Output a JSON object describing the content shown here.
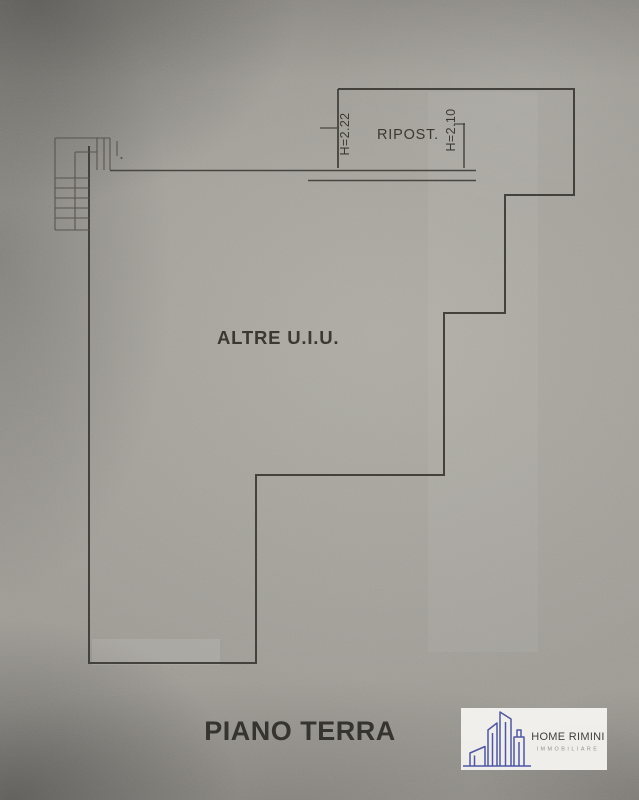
{
  "floorplan": {
    "room_label": "RIPOST.",
    "height_left": "H=2.22",
    "height_right": "H=2.10",
    "area_label": "ALTRE U.I.U.",
    "floor_label": "PIANO TERRA"
  },
  "logo": {
    "brand": "HOME RIMINI",
    "subtitle": "IMMOBILIARE",
    "icon": "buildings-skyline-icon",
    "accent_color": "#4a53a2",
    "panel_color": "#f4f3f0"
  },
  "colors": {
    "paper": "#9e9b95",
    "ink": "#413f3a"
  }
}
